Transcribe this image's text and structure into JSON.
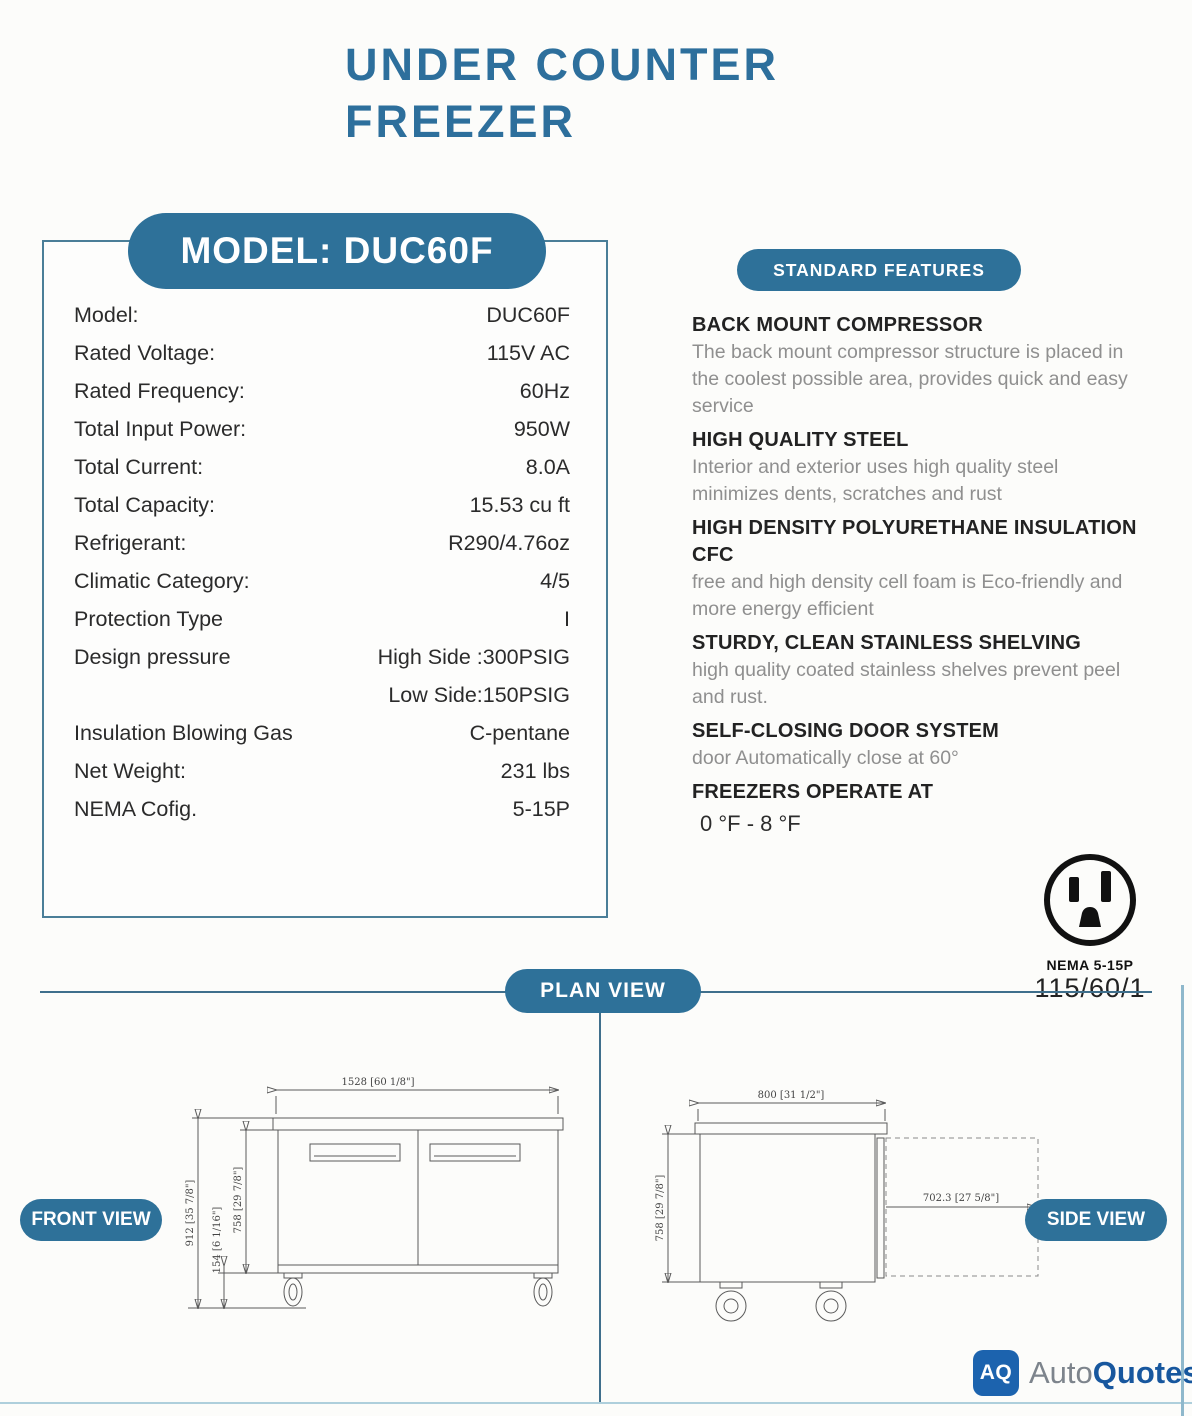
{
  "colors": {
    "accent": "#2e7199",
    "title": "#2d6f9c",
    "line": "#3f6f8c",
    "drawing": "#5a5a5a",
    "feature_body": "#8f8f8f",
    "logo_blue": "#1c63ae",
    "logo_text_blue": "#17579e"
  },
  "page": {
    "title_line1": "UNDER COUNTER",
    "title_line2": "FREEZER"
  },
  "model_panel": {
    "pill": "MODEL: DUC60F",
    "rows": [
      {
        "label": "Model:",
        "value": "DUC60F"
      },
      {
        "label": "Rated Voltage:",
        "value": "115V AC"
      },
      {
        "label": "Rated Frequency:",
        "value": "60Hz"
      },
      {
        "label": "Total Input Power:",
        "value": "950W"
      },
      {
        "label": "Total Current:",
        "value": "8.0A"
      },
      {
        "label": "Total Capacity:",
        "value": "15.53 cu ft"
      },
      {
        "label": "Refrigerant:",
        "value": "R290/4.76oz"
      },
      {
        "label": "Climatic Category:",
        "value": "4/5"
      },
      {
        "label": "Protection Type",
        "value": "I"
      },
      {
        "label": "Design pressure",
        "value": "High Side :300PSIG"
      },
      {
        "label": "",
        "value": "Low Side:150PSIG"
      },
      {
        "label": "Insulation Blowing Gas",
        "value": "C-pentane"
      },
      {
        "label": "Net Weight:",
        "value": "231 lbs"
      },
      {
        "label": "NEMA Cofig.",
        "value": "5-15P"
      }
    ]
  },
  "features": {
    "pill": "STANDARD FEATURES",
    "items": [
      {
        "heading": "BACK MOUNT COMPRESSOR",
        "body": "The back mount compressor structure is placed in the coolest possible area, provides quick and easy service"
      },
      {
        "heading": "HIGH QUALITY STEEL",
        "body": "Interior and exterior uses high quality steel minimizes dents, scratches and rust"
      },
      {
        "heading": "HIGH DENSITY POLYURETHANE INSULATION CFC",
        "body": "free and high density cell foam is Eco-friendly and more energy efficient"
      },
      {
        "heading": "STURDY, CLEAN STAINLESS SHELVING",
        "body": "high quality coated stainless shelves prevent peel and rust."
      },
      {
        "heading": "SELF-CLOSING DOOR SYSTEM",
        "body": "door Automatically close at 60°"
      },
      {
        "heading": "FREEZERS OPERATE AT",
        "body": "0 °F - 8 °F"
      }
    ]
  },
  "nema": {
    "label": "NEMA 5-15P",
    "power": "115/60/1"
  },
  "views": {
    "plan_pill": "PLAN VIEW",
    "front_pill": "FRONT VIEW",
    "side_pill": "SIDE VIEW",
    "front": {
      "width_dim": "1528 [60 1/8\"]",
      "height_dim": "912 [35 7/8\"]",
      "caster_dim": "154 [6 1/16\"]",
      "door_dim": "758 [29 7/8\"]"
    },
    "side": {
      "depth_dim": "800 [31 1/2\"]",
      "height_dim": "758 [29 7/8\"]",
      "door_swing_dim": "702.3 [27 5/8\"]"
    }
  },
  "footer": {
    "logo_monogram": "AQ",
    "logo_text_1": "Auto",
    "logo_text_2": "Quotes"
  }
}
